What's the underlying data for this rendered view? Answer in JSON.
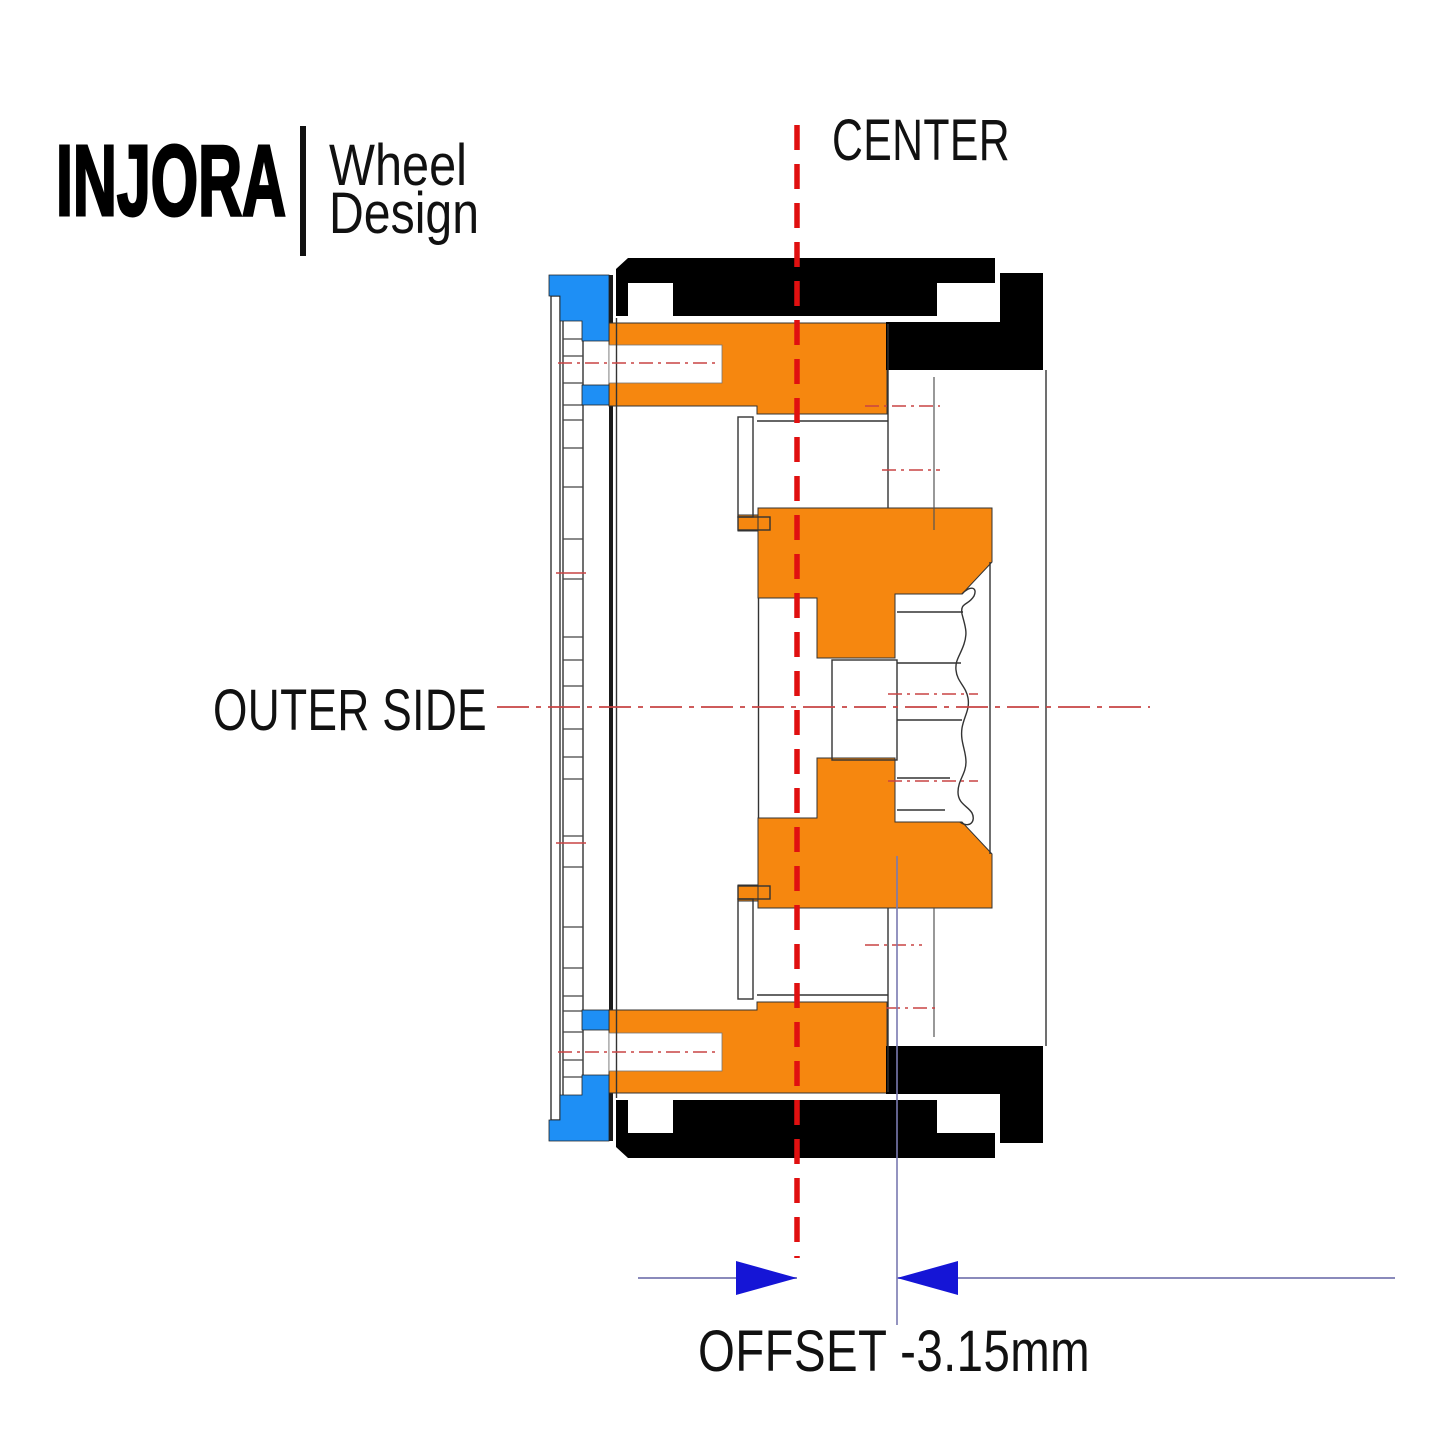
{
  "logo": {
    "brand": "INJORA",
    "line1": "Wheel",
    "line2": "Design"
  },
  "labels": {
    "center": "CENTER",
    "outer_side": "OUTER SIDE",
    "offset": "OFFSET -3.15mm"
  },
  "dimension": {
    "offset_value": -3.15,
    "unit": "mm"
  },
  "colors": {
    "wheel_orange": "#F6870F",
    "beadlock_blue": "#1E8FF5",
    "arrow_blue": "#1515D6",
    "center_line_red": "#E01010",
    "centerline_thin_red": "#C84444",
    "dimension_line_slate": "#8A8ABB",
    "tire_black": "#000000"
  }
}
